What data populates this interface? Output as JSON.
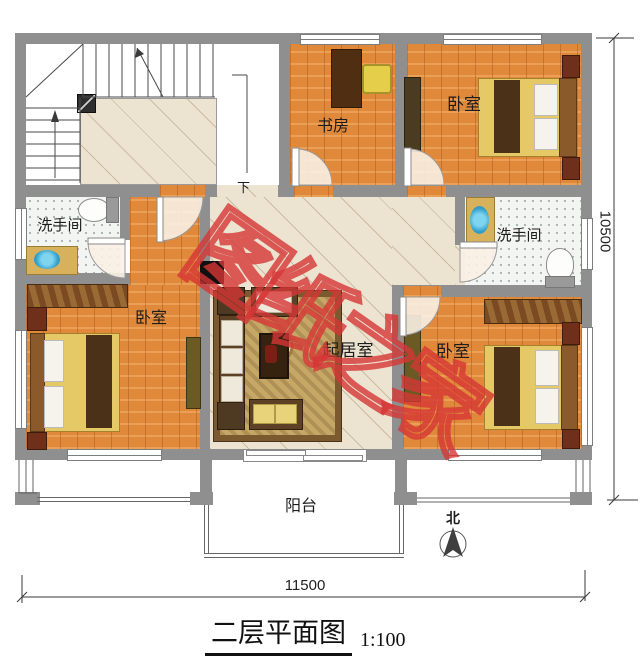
{
  "drawing": {
    "title": "二层平面图",
    "scale": "1:100",
    "dim_width": "11500",
    "dim_height": "10500",
    "north_label": "北",
    "stair_label": "下",
    "watermark": "图纸之家"
  },
  "rooms": {
    "study": "书房",
    "bedroom_top_right": "卧室",
    "bedroom_left": "卧室",
    "bedroom_bottom_right": "卧室",
    "bathroom_left": "洗手间",
    "bathroom_right": "洗手间",
    "living": "起居室",
    "balcony": "阳台"
  },
  "colors": {
    "wall": "#8f8f8f",
    "wood_floor": "#e1893b",
    "hall_tile": "#ece3d0",
    "watermark_red": "#d63636"
  }
}
